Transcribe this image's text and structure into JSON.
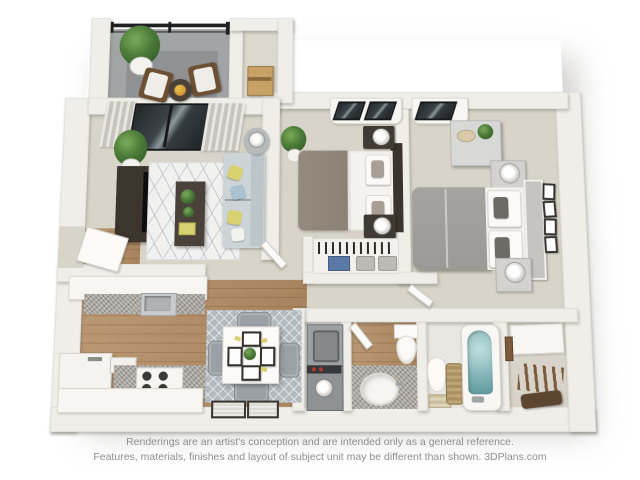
{
  "footer": {
    "line1": "Renderings are an artist's conception and are intended only as a general reference.",
    "line2": "Features, materials, finishes and layout of subject unit may be different than shown. 3DPlans.com"
  },
  "plan": {
    "type": "3d-floorplan-top-view",
    "rooms": [
      "balcony",
      "storage-closet",
      "living-room",
      "bedroom-1",
      "bedroom-2",
      "hallway",
      "kitchen",
      "dining-area",
      "laundry-closet",
      "bathroom-1",
      "bathroom-2",
      "walk-in-closet"
    ]
  },
  "colors": {
    "wall": "#f0eee8",
    "wall-edge": "#d9d5cb",
    "carpet": "#d8d4c9",
    "wood": "#b28c63",
    "balcony": "#a2a4a5",
    "glass": "#41464a",
    "dark-furniture": "#3c352d",
    "sofa": "#cdd4d7",
    "rug-living": "#f1f1f0",
    "rug-dining": "#b2b9bf",
    "granite": "#aaa69e",
    "bed1-duvet": "#8b8175",
    "bed2-duvet": "#9c9a97",
    "white-furniture": "#f7f6f3",
    "plant": "#4c7b39",
    "water": "#84b6b8",
    "cardboard": "#c7a166",
    "appliance": "#9ba0a3",
    "accent-yellow": "#d8d170",
    "accent-blue": "#a9c3d3",
    "accent-red": "#b03a30",
    "text": "#8f8f8f"
  }
}
